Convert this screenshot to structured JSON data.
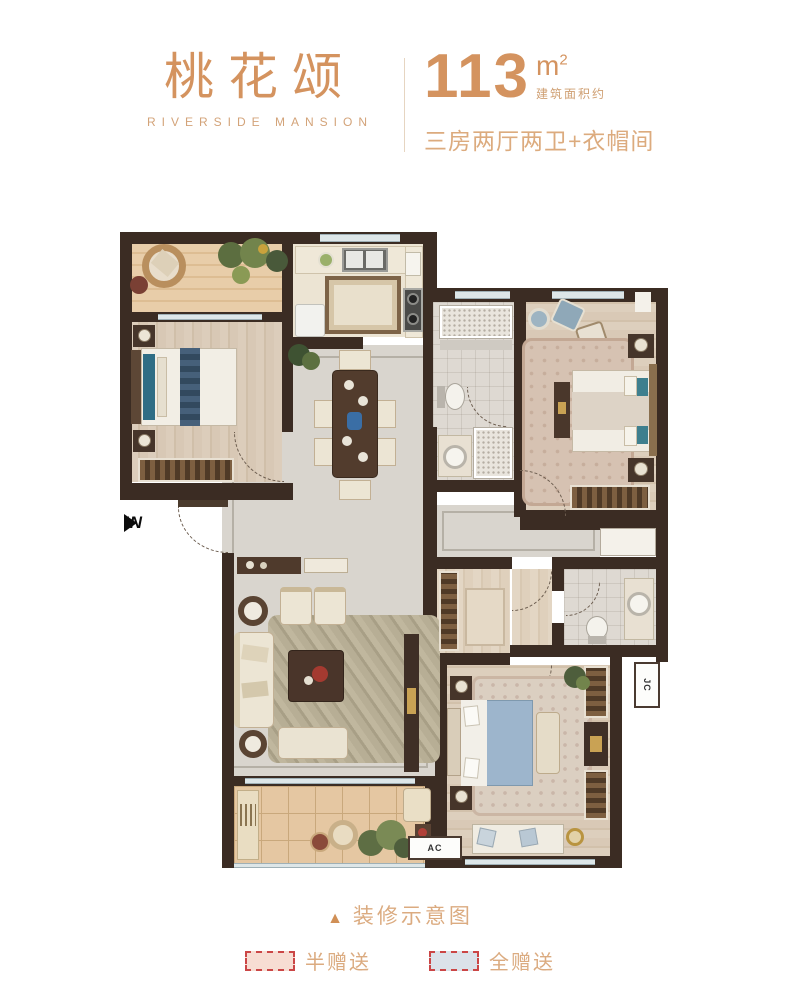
{
  "header": {
    "title": "桃花颂",
    "subtitle": "RIVERSIDE MANSION",
    "area_value": "113",
    "area_unit_base": "m",
    "area_unit_exp": "2",
    "area_note": "建筑面积约",
    "layout_desc": "三房两厅两卫+衣帽间"
  },
  "plan": {
    "entrance_label": "IN",
    "ac_platform_label": "AC",
    "side_platform_label": "JC"
  },
  "footer": {
    "marker": "▲",
    "caption": "装修示意图",
    "legend": [
      {
        "label": "半赠送",
        "fill": "#f7ddd3",
        "border": "#cb4646"
      },
      {
        "label": "全赠送",
        "fill": "#dbe2ea",
        "border": "#cb4646"
      }
    ]
  },
  "colors": {
    "accent": "#d4935f",
    "text_secondary": "#dcab7e",
    "wall": "#3b2c23"
  }
}
